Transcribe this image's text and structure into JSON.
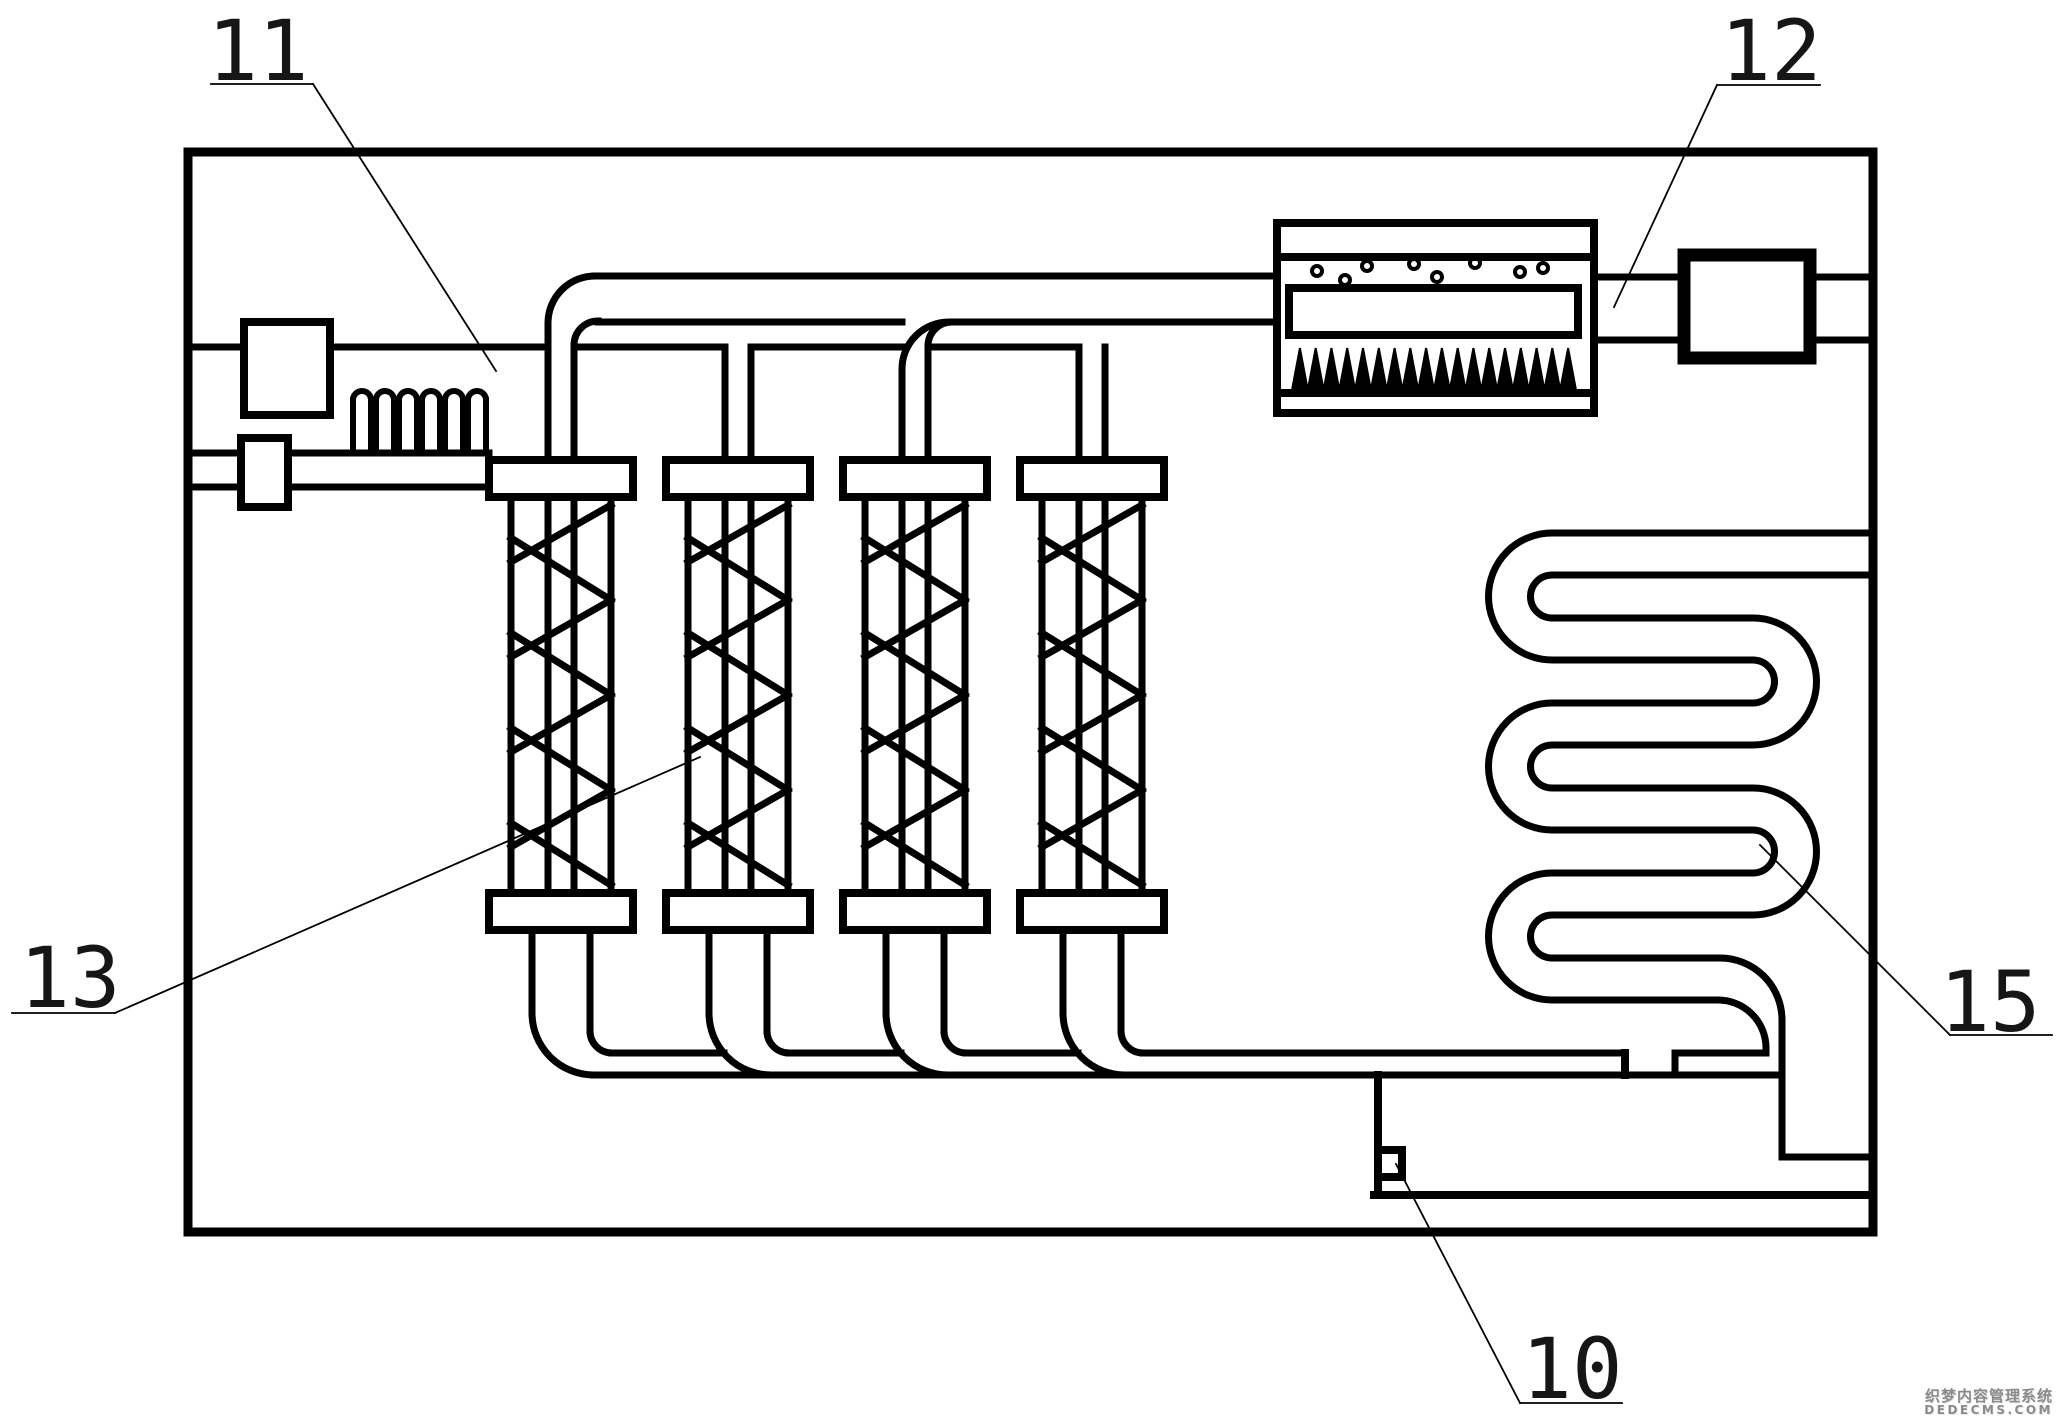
{
  "figure": {
    "background": "#ffffff",
    "line_color": "#000000",
    "type": "patent-style piping / heat-treatment system diagram"
  },
  "labels": {
    "n11": "11",
    "n12": "12",
    "n13": "13",
    "n15": "15",
    "n10": "10"
  },
  "watermark": {
    "line1": "织梦内容管理系统",
    "line2": "DEDECMS.COM",
    "color": "#8a8a8a"
  }
}
